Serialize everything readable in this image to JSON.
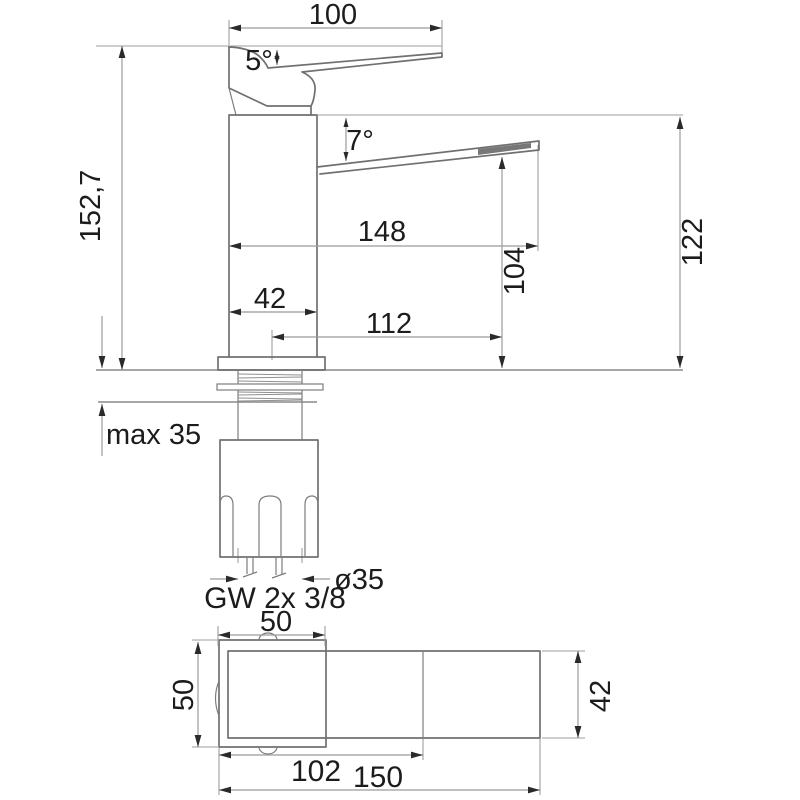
{
  "drawing_title": "basin mixer tap dimensional drawing",
  "colors": {
    "background": "#ffffff",
    "outline": "#707070",
    "dimension_line": "#9b9b9b",
    "text": "#1c1c1c",
    "arrow": "#2a2a2a"
  },
  "elevation": {
    "dim_handle_length": "100",
    "dim_handle_angle": "5°",
    "dim_spout_angle": "7°",
    "dim_total_height": "152,7",
    "dim_spout_reach": "148",
    "dim_body_height": "122",
    "dim_outlet_height": "104",
    "dim_body_width": "42",
    "dim_outlet_reach": "112",
    "dim_mount_thickness": "max 35",
    "dim_shank_diameter": "ø35",
    "dim_hose_thread": "GW 2x 3/8"
  },
  "plan": {
    "dim_plate_width": "50",
    "dim_plate_depth": "50",
    "dim_body_length": "102",
    "dim_total_length": "150",
    "dim_body_depth": "42"
  }
}
